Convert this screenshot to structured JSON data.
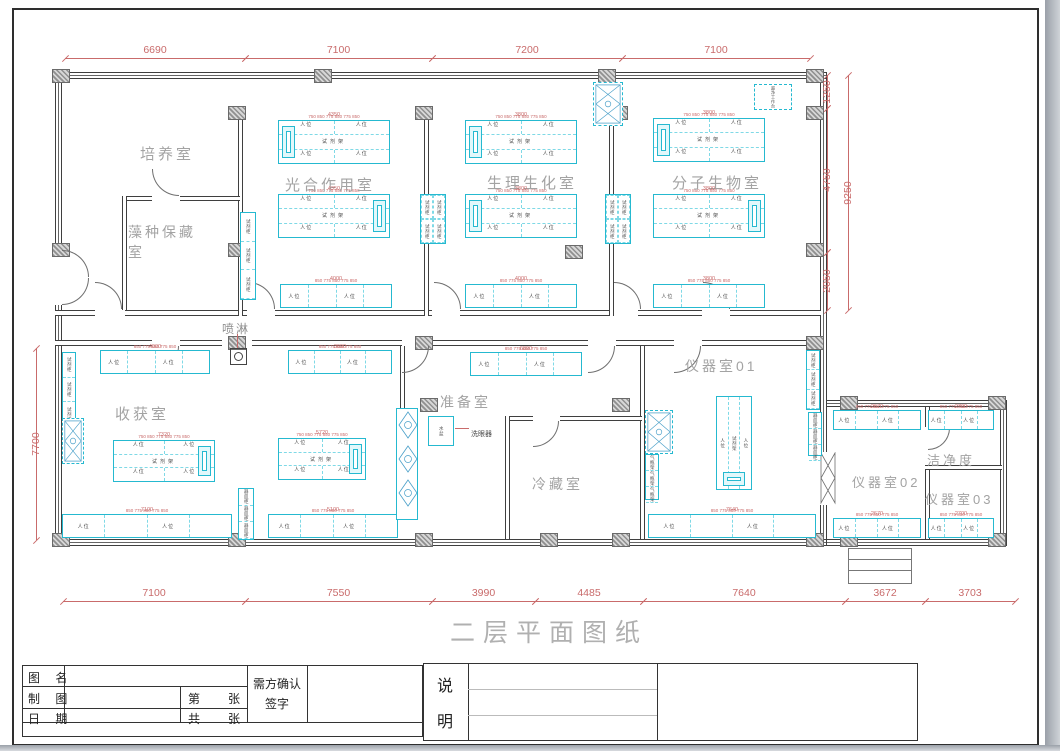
{
  "page_title": "二层平面图纸",
  "rooms": [
    {
      "name": "培养室"
    },
    {
      "name": "藻种保藏室"
    },
    {
      "name": "光合作用室"
    },
    {
      "name": "生理生化室"
    },
    {
      "name": "分子生物室"
    },
    {
      "name": "收获室"
    },
    {
      "name": "准备室"
    },
    {
      "name": "冷藏室"
    },
    {
      "name": "仪器室01"
    },
    {
      "name": "仪器室02"
    },
    {
      "name": "仪器室03"
    },
    {
      "name": "洁净度"
    }
  ],
  "fixtures": {
    "spray": "喷淋",
    "eyewash": "洗眼器",
    "basin": "水盆",
    "clean_bench": "超净工作台"
  },
  "bench_labels": {
    "seat": "人位",
    "rack": "试剂架",
    "cabinet": "试剂柜",
    "vessel": "器皿柜",
    "gas": "气瓶架",
    "seat_dims": "750 850 775 850 775 850",
    "row_dims": "850 775 850 775 850"
  },
  "dims": {
    "top": [
      "6690",
      "7100",
      "7200",
      "7100"
    ],
    "bottom": [
      "7100",
      "7550",
      "3990",
      "4485",
      "7640",
      "3672",
      "3703"
    ],
    "left": "7700",
    "right": [
      "1250",
      "4750",
      "2050"
    ],
    "right_outer": "9250",
    "micro": [
      "4350",
      "3800",
      "3800",
      "4350",
      "3800",
      "3800",
      "4000",
      "4000",
      "3800",
      "4000",
      "3690",
      "6890",
      "7320",
      "5720",
      "7100",
      "5100",
      "7640",
      "2670",
      "2700",
      "2670",
      "2700"
    ]
  },
  "title_block": {
    "name_label": "图 名",
    "draft_label": "制 图",
    "date_label": "日 期",
    "no_pre": "第",
    "no_unit": "张",
    "total_pre": "共",
    "total_unit": "张",
    "confirm1": "需方确认",
    "confirm2": "签字",
    "note1": "说",
    "note2": "明"
  },
  "colors": {
    "bench": "#25b9d0",
    "dim": "#c96b6b",
    "room": "#a3a3a3",
    "wall": "#3f3f3f"
  }
}
